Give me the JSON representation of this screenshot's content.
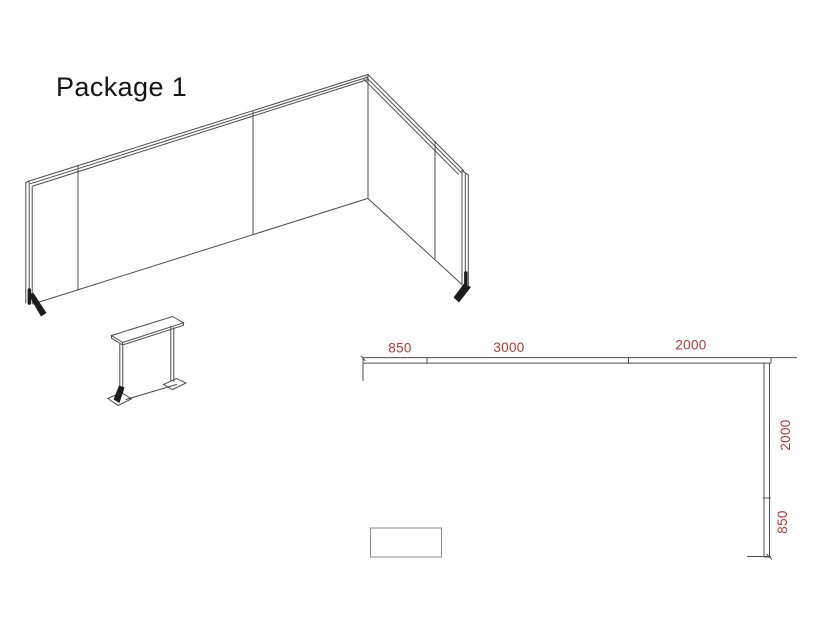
{
  "title": "Package 1",
  "colors": {
    "line": "#4d4d4d",
    "dimension": "#b23a36",
    "foot": "#1c1c1c",
    "table_outline": "#8a8a8a"
  },
  "floor_plan": {
    "top_dimensions": [
      {
        "label": "850"
      },
      {
        "label": "3000"
      },
      {
        "label": "2000"
      }
    ],
    "side_dimensions": [
      {
        "label": "2000"
      },
      {
        "label": "850"
      }
    ]
  }
}
